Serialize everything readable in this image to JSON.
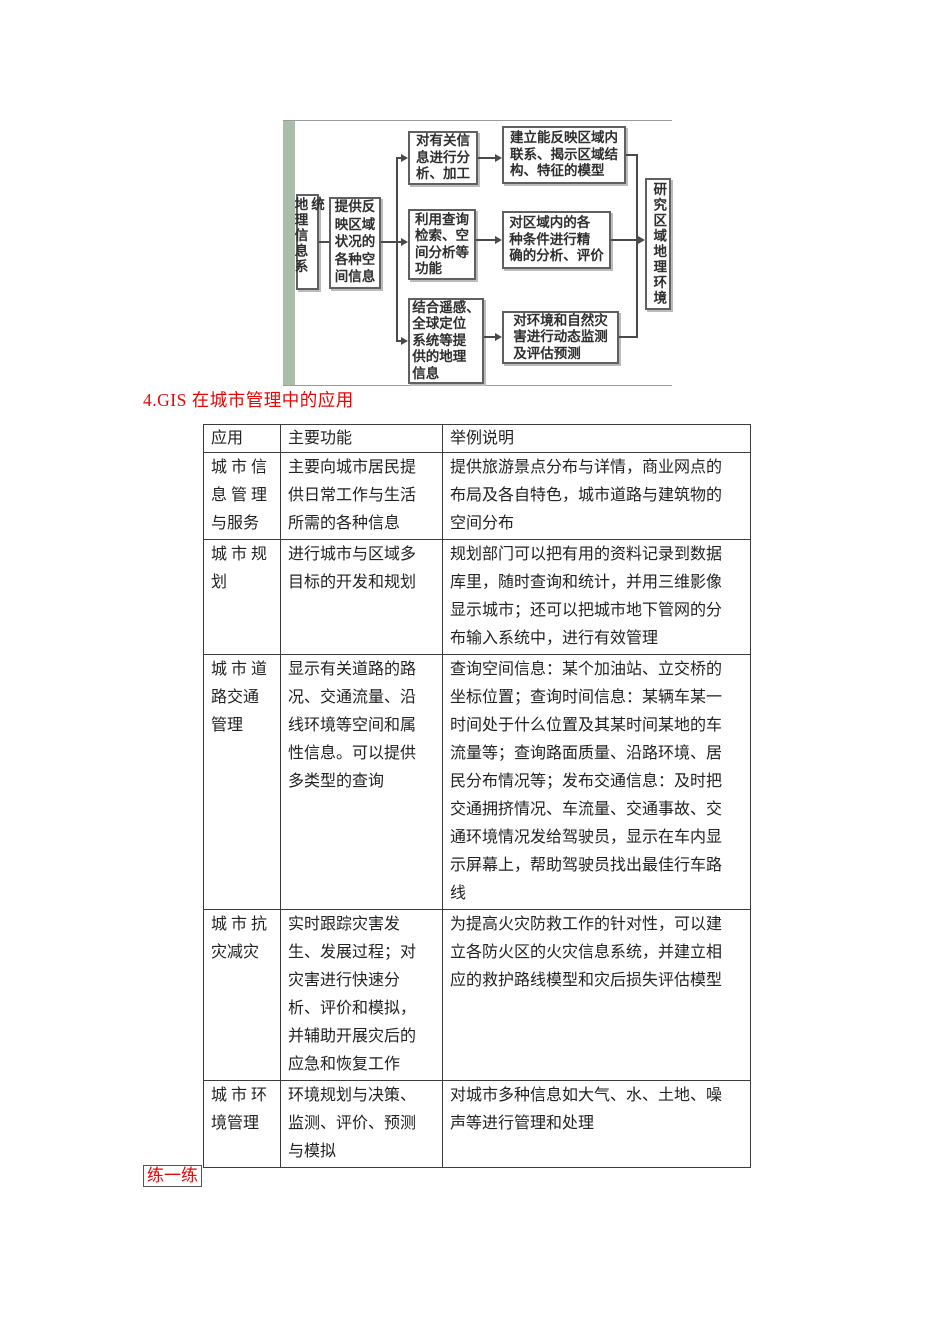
{
  "heading": {
    "text": "4.GIS 在城市管理中的应用",
    "color": "#e60606"
  },
  "practice": {
    "text": "练一练",
    "color": "#e60606"
  },
  "flowchart": {
    "accent_bar_color": "#a9bda9",
    "source_box": "地理信息系统",
    "provide_box": "提供反\n映区域\n状况的\n各种空\n间信息",
    "middle_boxes": [
      "对有关信\n息进行分\n析、加工",
      "利用查询\n检索、空\n间分析等\n功能",
      "结合遥感、\n全球定位\n系统等提\n供的地理\n信息"
    ],
    "right_boxes": [
      "建立能反映区域内\n联系、揭示区域结\n构、特征的模型",
      "对区域内的各\n种条件进行精\n确的分析、评价",
      "对环境和自然灾\n害进行动态监测\n及评估预测"
    ],
    "result_box": "研究区域地理环境"
  },
  "table": {
    "headers": [
      "应用",
      "主要功能",
      "举例说明"
    ],
    "rows": [
      {
        "app": "城 市 信\n息 管 理\n与服务",
        "func": "主要向城市居民提\n供日常工作与生活\n所需的各种信息",
        "example": "提供旅游景点分布与详情，商业网点的\n布局及各自特色，城市道路与建筑物的\n空间分布"
      },
      {
        "app": "城 市 规\n划",
        "func": "进行城市与区域多\n目标的开发和规划",
        "example": "规划部门可以把有用的资料记录到数据\n库里，随时查询和统计，并用三维影像\n显示城市；还可以把城市地下管网的分\n布输入系统中，进行有效管理"
      },
      {
        "app": "城 市 道\n路交通\n管理",
        "func": "显示有关道路的路\n况、交通流量、沿\n线环境等空间和属\n性信息。可以提供\n多类型的查询",
        "example": "查询空间信息：某个加油站、立交桥的\n坐标位置；查询时间信息：某辆车某一\n时间处于什么位置及其某时间某地的车\n流量等；查询路面质量、沿路环境、居\n民分布情况等；发布交通信息：及时把\n交通拥挤情况、车流量、交通事故、交\n通环境情况发给驾驶员，显示在车内显\n示屏幕上，帮助驾驶员找出最佳行车路\n线"
      },
      {
        "app": "城 市 抗\n灾减灾",
        "func": "实时跟踪灾害发\n生、发展过程；对\n灾害进行快速分\n析、评价和模拟，\n并辅助开展灾后的\n应急和恢复工作",
        "example": "为提高火灾防救工作的针对性，可以建\n立各防火区的火灾信息系统，并建立相\n应的救护路线模型和灾后损失评估模型"
      },
      {
        "app": "城 市 环\n境管理",
        "func": "环境规划与决策、\n监测、评价、预测\n与模拟",
        "example": "对城市多种信息如大气、水、土地、噪\n声等进行管理和处理"
      }
    ]
  }
}
